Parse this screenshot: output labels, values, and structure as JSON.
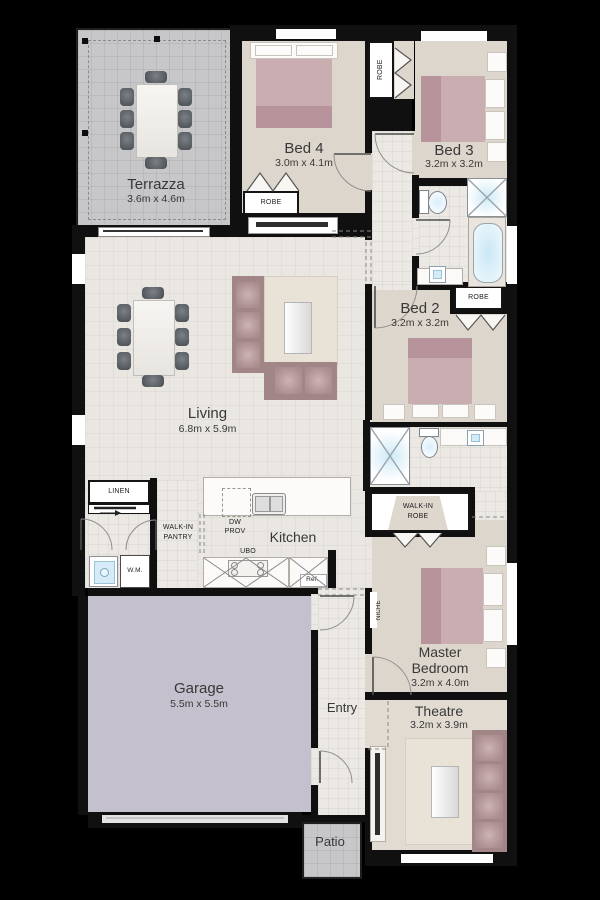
{
  "rooms": {
    "terrazza": {
      "name": "Terrazza",
      "dims": "3.6m x 4.6m"
    },
    "bed4": {
      "name": "Bed 4",
      "dims": "3.0m x 4.1m"
    },
    "bed3": {
      "name": "Bed 3",
      "dims": "3.2m x 3.2m"
    },
    "bed2": {
      "name": "Bed 2",
      "dims": "3.2m x 3.2m"
    },
    "living": {
      "name": "Living",
      "dims": "6.8m x 5.9m"
    },
    "kitchen": {
      "name": "Kitchen"
    },
    "garage": {
      "name": "Garage",
      "dims": "5.5m x 5.5m"
    },
    "master": {
      "l1": "Master",
      "l2": "Bedroom",
      "dims": "3.2m x 4.0m"
    },
    "theatre": {
      "name": "Theatre",
      "dims": "3.2m x 3.9m"
    },
    "entry": {
      "name": "Entry"
    },
    "patio": {
      "name": "Patio"
    }
  },
  "storage": {
    "robe_bed4": "ROBE",
    "robe_bed3": "ROBE",
    "robe_bed2": "ROBE",
    "walk_in_robe": {
      "l1": "WALK-IN",
      "l2": "ROBE"
    },
    "walk_in_pantry": {
      "l1": "WALK-IN",
      "l2": "PANTRY"
    },
    "linen": "LINEN",
    "niche": "NICHE"
  },
  "appliances": {
    "wm": "W.M.",
    "dw": {
      "l1": "DW",
      "l2": "PROV"
    },
    "ubo": "UBO",
    "ref": "Ref."
  },
  "colors": {
    "background": "#000000",
    "wall": "#101010",
    "floor_tile": "#ece8e3",
    "floor_living": "#eae6e1",
    "floor_bedroom": "#ddd6cd",
    "outdoor": "#c7c7ca",
    "garage": "#c5c0cd",
    "bed_mauve": "#c9adb1",
    "sofa_mauve": "#a18587",
    "water_blue": "#cdeaf6"
  }
}
